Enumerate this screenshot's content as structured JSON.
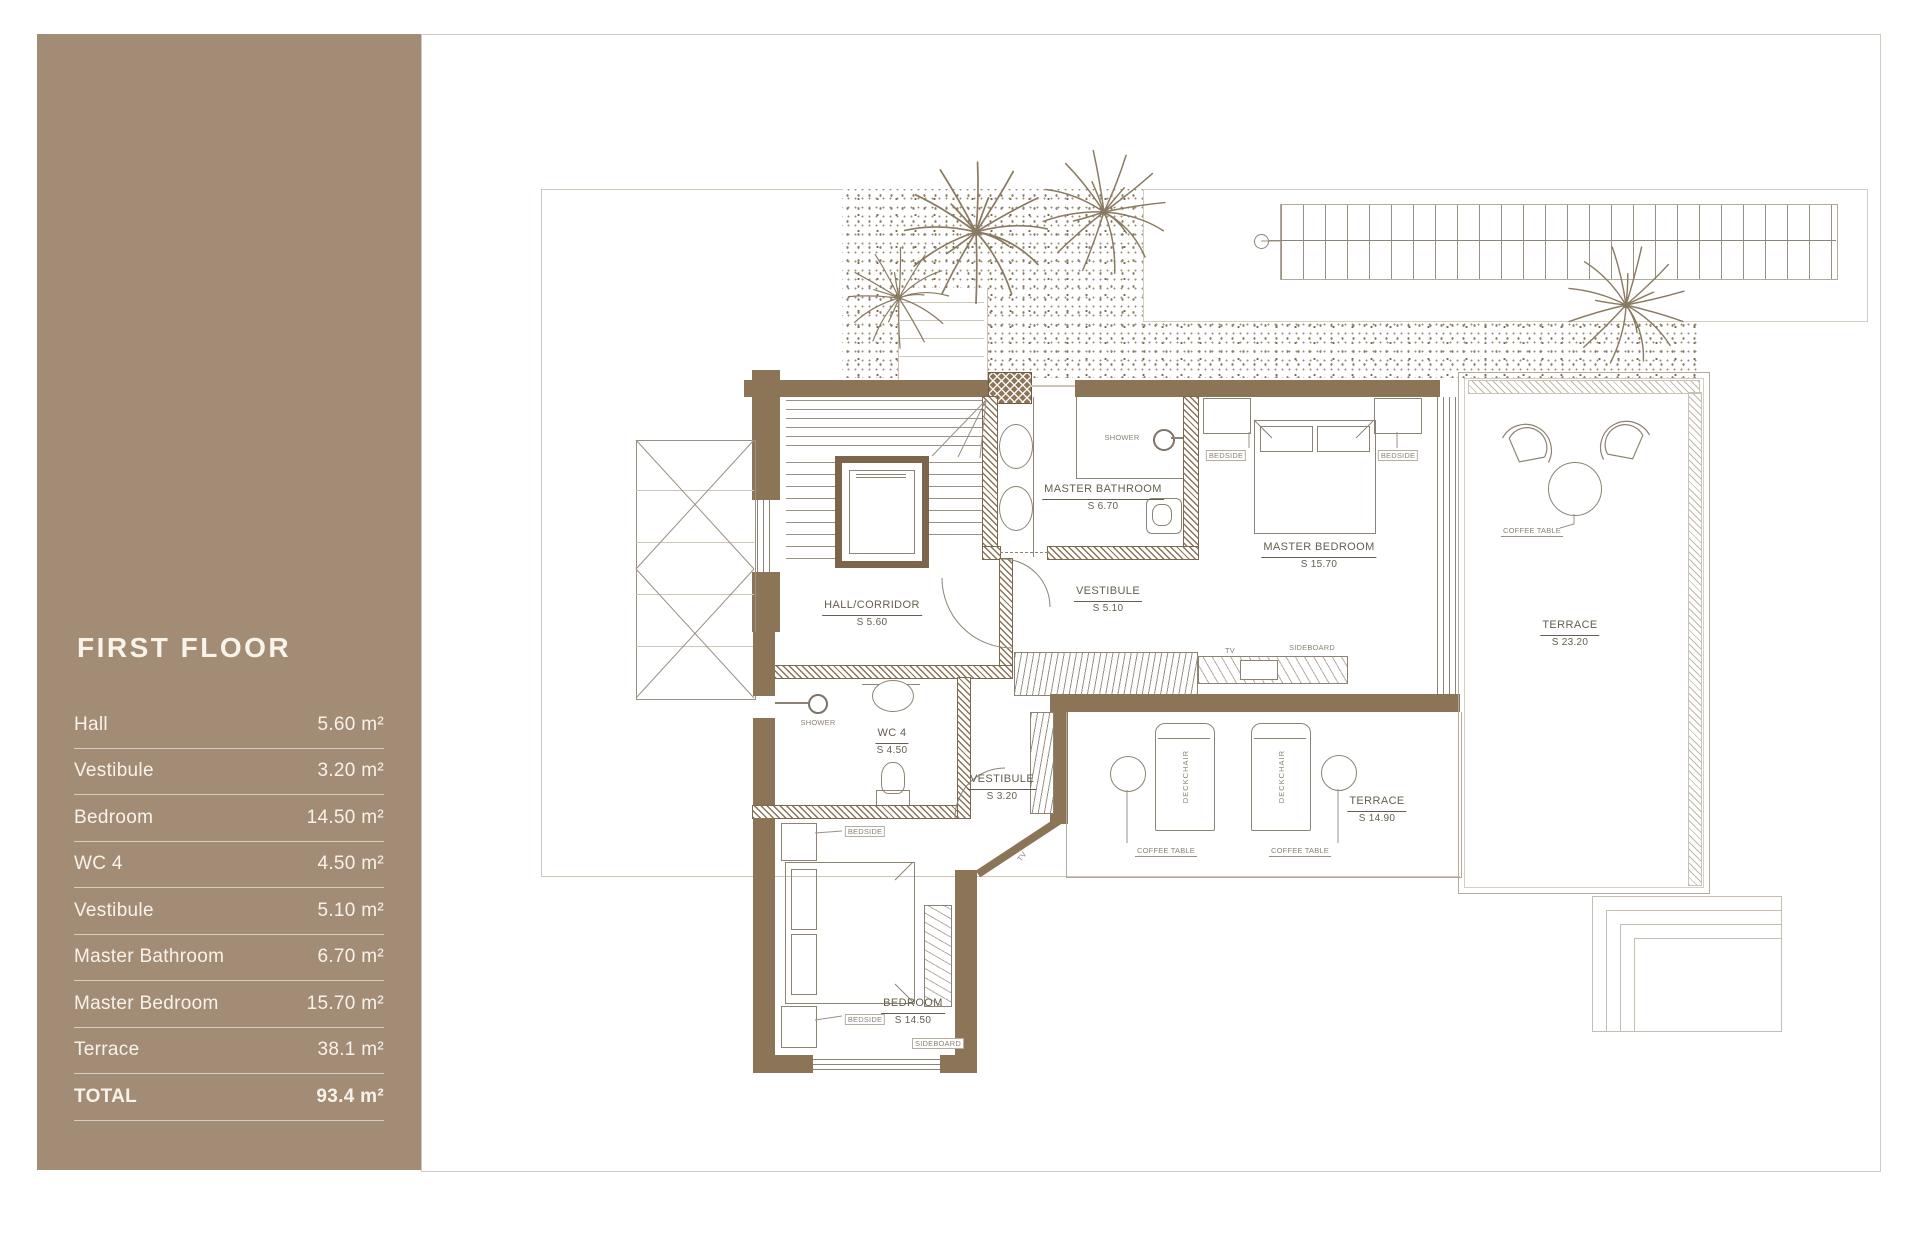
{
  "sidebar": {
    "title": "FIRST FLOOR",
    "rows": [
      {
        "label": "Hall",
        "value": "5.60 m²"
      },
      {
        "label": "Vestibule",
        "value": "3.20 m²"
      },
      {
        "label": "Bedroom",
        "value": "14.50 m²"
      },
      {
        "label": "WC 4",
        "value": "4.50 m²"
      },
      {
        "label": "Vestibule",
        "value": "5.10 m²"
      },
      {
        "label": "Master Bathroom",
        "value": "6.70 m²"
      },
      {
        "label": "Master Bedroom",
        "value": "15.70 m²"
      },
      {
        "label": "Terrace",
        "value": "38.1 m²"
      },
      {
        "label": "TOTAL",
        "value": "93.4 m²"
      }
    ]
  },
  "plan": {
    "rooms": [
      {
        "name": "HALL/CORRIDOR",
        "area": "S 5.60"
      },
      {
        "name": "VESTIBULE",
        "area": "S 5.10"
      },
      {
        "name": "MASTER BATHROOM",
        "area": "S 6.70"
      },
      {
        "name": "MASTER BEDROOM",
        "area": "S 15.70"
      },
      {
        "name": "TERRACE",
        "area": "S 23.20"
      },
      {
        "name": "WC 4",
        "area": "S 4.50"
      },
      {
        "name": "VESTIBULE",
        "area": "S 3.20"
      },
      {
        "name": "BEDROOM",
        "area": "S 14.50"
      },
      {
        "name": "TERRACE",
        "area": "S 14.90"
      }
    ],
    "furniture": {
      "shower": "SHOWER",
      "bedside": "BEDSIDE",
      "sideboard": "SIDEBOARD",
      "tv": "TV",
      "deckchair": "DECKCHAIR",
      "coffee_table": "COFFEE TABLE"
    }
  },
  "colors": {
    "sidebar_bg": "#a28c76",
    "wall": "#8c7457",
    "drawing_line": "#8d8374",
    "plan_text": "#655e4f",
    "sidebar_text": "#f8f3ea"
  }
}
